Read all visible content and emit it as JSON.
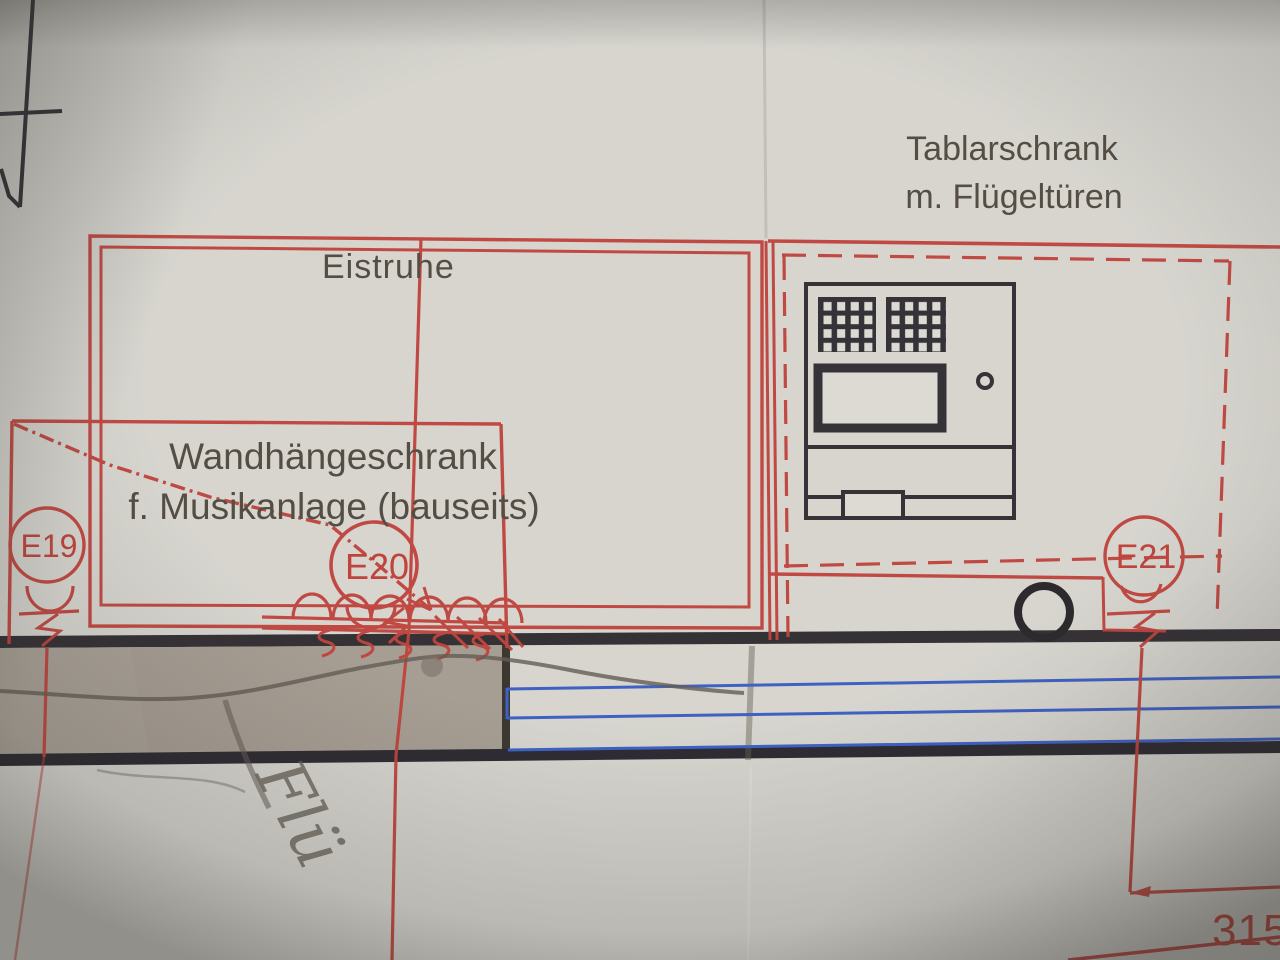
{
  "plan": {
    "cabinet_labels": {
      "tablarschrank_line1": "Tablarschrank",
      "tablarschrank_line2": "m. Flügeltüren",
      "eistruhe": "Eistruhe",
      "wandhaengeschrank_line1": "Wandhängeschrank",
      "wandhaengeschrank_line2": "f. Musikanlage (bauseits)"
    },
    "outlets": [
      {
        "id": "E19"
      },
      {
        "id": "E20"
      },
      {
        "id": "E21"
      }
    ],
    "dimension": {
      "value": "3150"
    },
    "handwriting": {
      "text": "Flü"
    },
    "colors": {
      "plan_red": "#bd3530",
      "ink_black": "#23202a",
      "guide_blue": "#2d55c5",
      "paper": "#d7d6d1",
      "wall_gray": "#a49c92",
      "label_ink": "#453f37",
      "pencil": "#56514a"
    }
  }
}
